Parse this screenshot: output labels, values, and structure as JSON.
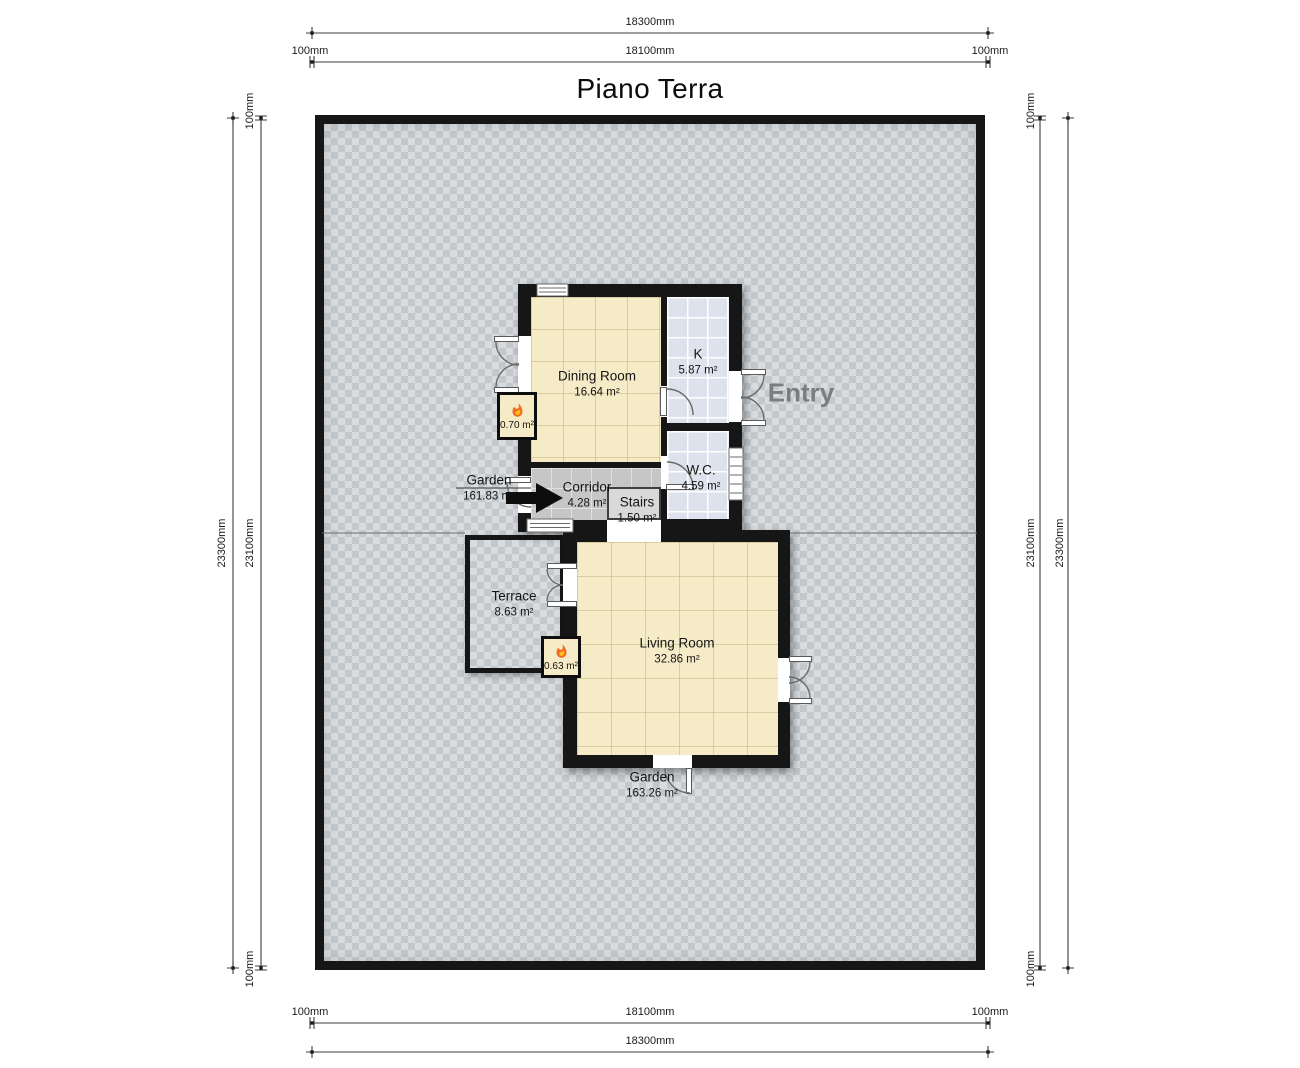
{
  "title": "Piano Terra",
  "dimensions": {
    "top": {
      "total": "18300mm",
      "left": "100mm",
      "inner": "18100mm",
      "right": "100mm"
    },
    "bottom": {
      "left": "100mm",
      "inner": "18100mm",
      "right": "100mm",
      "total": "18300mm"
    },
    "left": {
      "total": "23300mm",
      "inner": "23100mm",
      "top": "100mm",
      "bottom": "100mm"
    },
    "right": {
      "inner": "23100mm",
      "total": "23300mm",
      "top": "100mm",
      "bottom": "100mm"
    }
  },
  "entry": {
    "label": "Entry"
  },
  "rooms": {
    "dining": {
      "name": "Dining Room",
      "area": "16.64 m²"
    },
    "kitchen": {
      "name": "K",
      "area": "5.87 m²"
    },
    "wc": {
      "name": "W.C.",
      "area": "4.59 m²"
    },
    "corridor": {
      "name": "Corridor",
      "area": "4.28 m²"
    },
    "stairs": {
      "name": "Stairs",
      "area": "1.50 m²"
    },
    "terrace": {
      "name": "Terrace",
      "area": "8.63 m²"
    },
    "living": {
      "name": "Living Room",
      "area": "32.86 m²"
    },
    "garden_upper": {
      "name": "Garden",
      "area": "161.83 m²"
    },
    "garden_lower": {
      "name": "Garden",
      "area": "163.26 m²"
    }
  },
  "fireplaces": {
    "dining": {
      "area": "0.70 m²"
    },
    "living": {
      "area": "0.63 m²"
    }
  },
  "colors": {
    "wall": "#161616",
    "dining_floor": "#f6ebc7",
    "living_floor": "#f6ebc7",
    "kitchen_floor": "#dee2ec",
    "wc_floor": "#dee2ec",
    "corridor_floor": "#c6c6c6",
    "stairs_floor": "#d9d9d9",
    "garden_base": "#d9dcdf",
    "flame": "#f26b1d",
    "entry_text": "#7d7d7d"
  }
}
